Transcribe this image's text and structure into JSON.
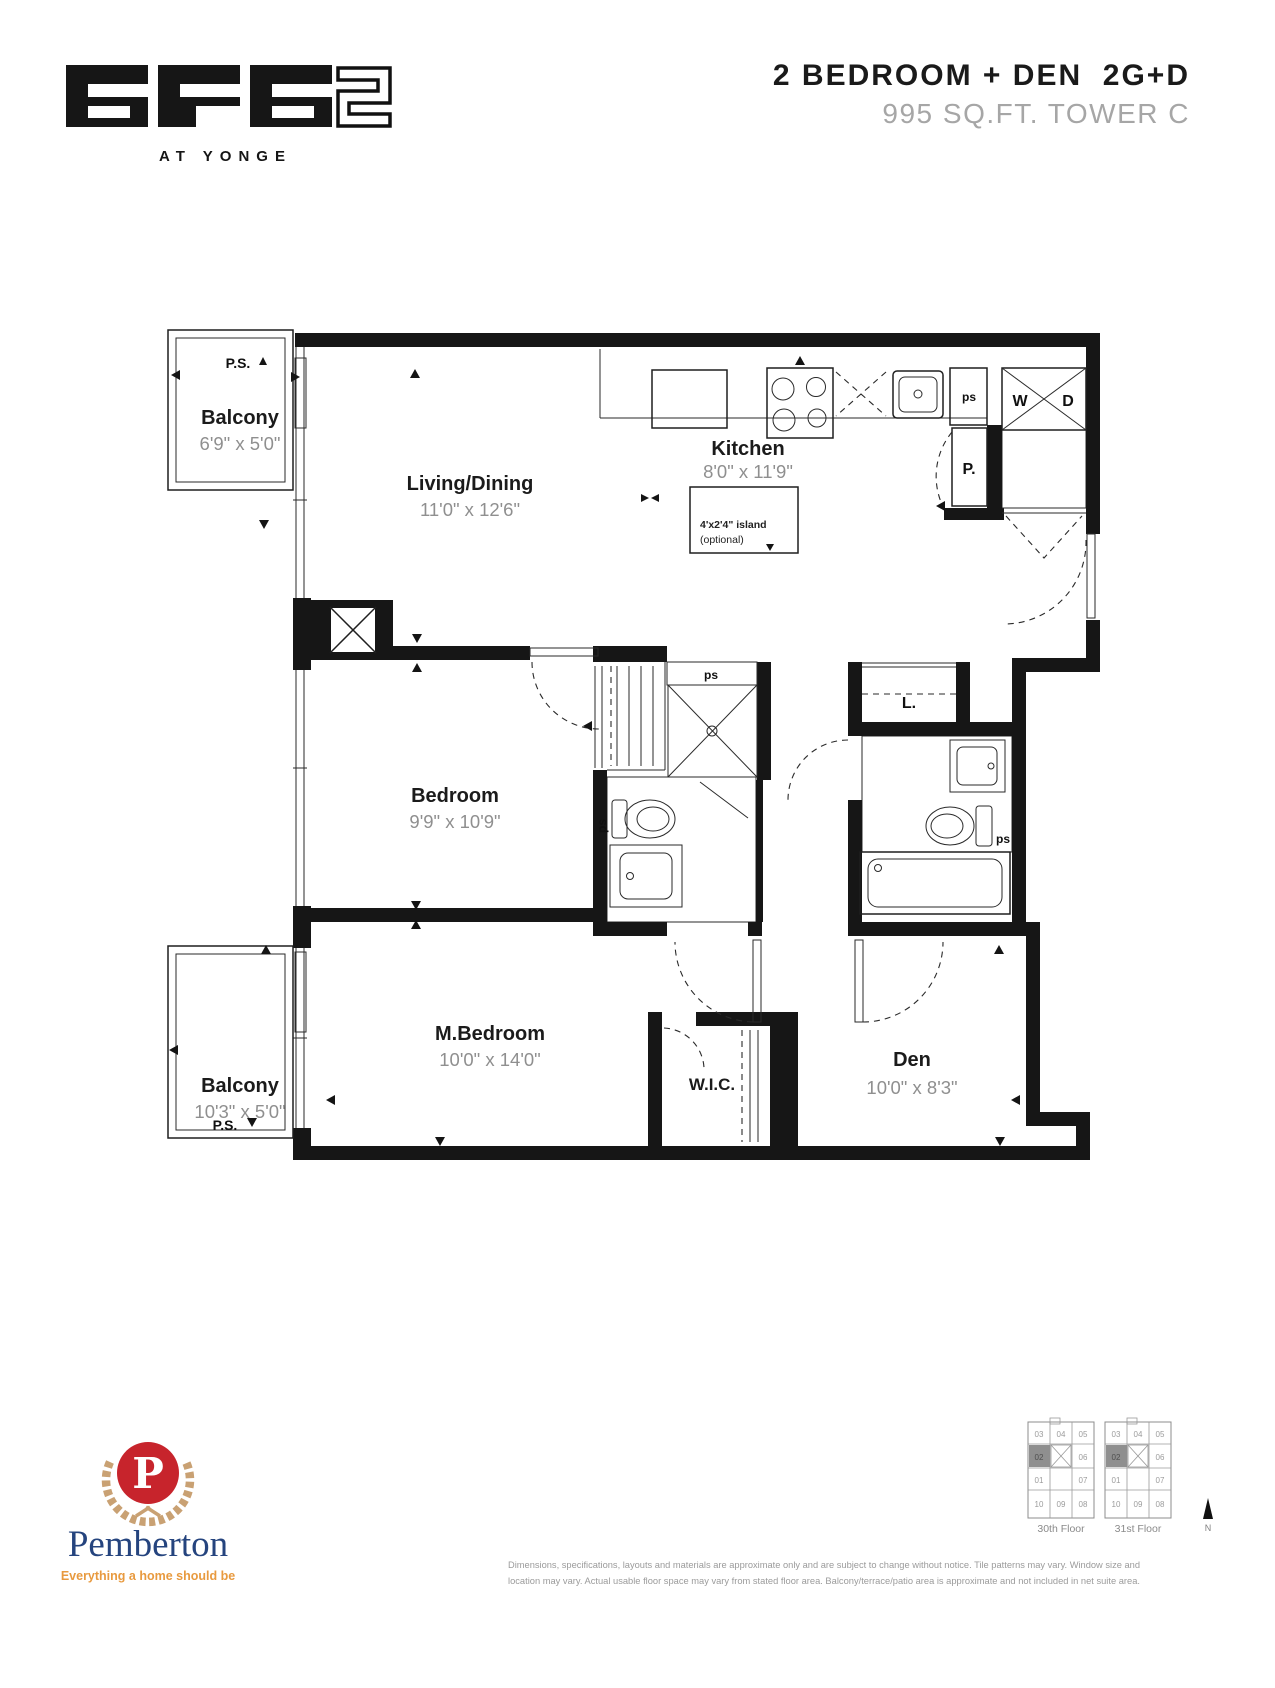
{
  "header": {
    "logo_word": "era",
    "logo_number": "2",
    "logo_tagline": "AT YONGE",
    "title": "2 BEDROOM + DEN  2G+D",
    "subtitle": "995 SQ.FT. TOWER C"
  },
  "plan": {
    "balcony_top": {
      "name": "Balcony",
      "dims": "6'9\" x 5'0\"",
      "ps": "P.S."
    },
    "living": {
      "name": "Living/Dining",
      "dims": "11'0\" x 12'6\""
    },
    "kitchen": {
      "name": "Kitchen",
      "dims": "8'0\" x 11'9\"",
      "island_line1": "4'x2'4\" island",
      "island_line2": "(optional)",
      "pantry": "P.",
      "washer": "W",
      "dryer": "D"
    },
    "bedroom": {
      "name": "Bedroom",
      "dims": "9'9\" x 10'9\""
    },
    "master": {
      "name": "M.Bedroom",
      "dims": "10'0\" x 14'0\""
    },
    "wic": {
      "name": "W.I.C."
    },
    "den": {
      "name": "Den",
      "dims": "10'0\" x 8'3\""
    },
    "balcony_bottom": {
      "name": "Balcony",
      "dims": "10'3\" x 5'0\"",
      "ps": "P.S."
    },
    "linen": "L.",
    "ps": "ps"
  },
  "footer": {
    "builder": {
      "name": "Pemberton",
      "tagline": "Everything a home should be",
      "monogram": "P"
    },
    "keyplans": {
      "floors": [
        "30th Floor",
        "31st Floor"
      ],
      "units": [
        "03",
        "04",
        "05",
        "02",
        "06",
        "01",
        "07",
        "10",
        "09",
        "08"
      ],
      "highlighted_unit": "02",
      "north_label": "N"
    },
    "disclaimer_line1": "Dimensions, specifications, layouts and materials are approximate only and are subject to change without notice. Tile patterns may vary. Window size and",
    "disclaimer_line2": "location may vary. Actual usable floor space may vary from stated floor area. Balcony/terrace/patio area is approximate and not included in net suite area."
  },
  "colors": {
    "accent_red": "#c7242c",
    "wreath_gold": "#c9a173",
    "navy": "#25447e",
    "tagline_orange": "#e89a3f",
    "line": "#161616",
    "dim_gray": "#8f8f8f"
  }
}
